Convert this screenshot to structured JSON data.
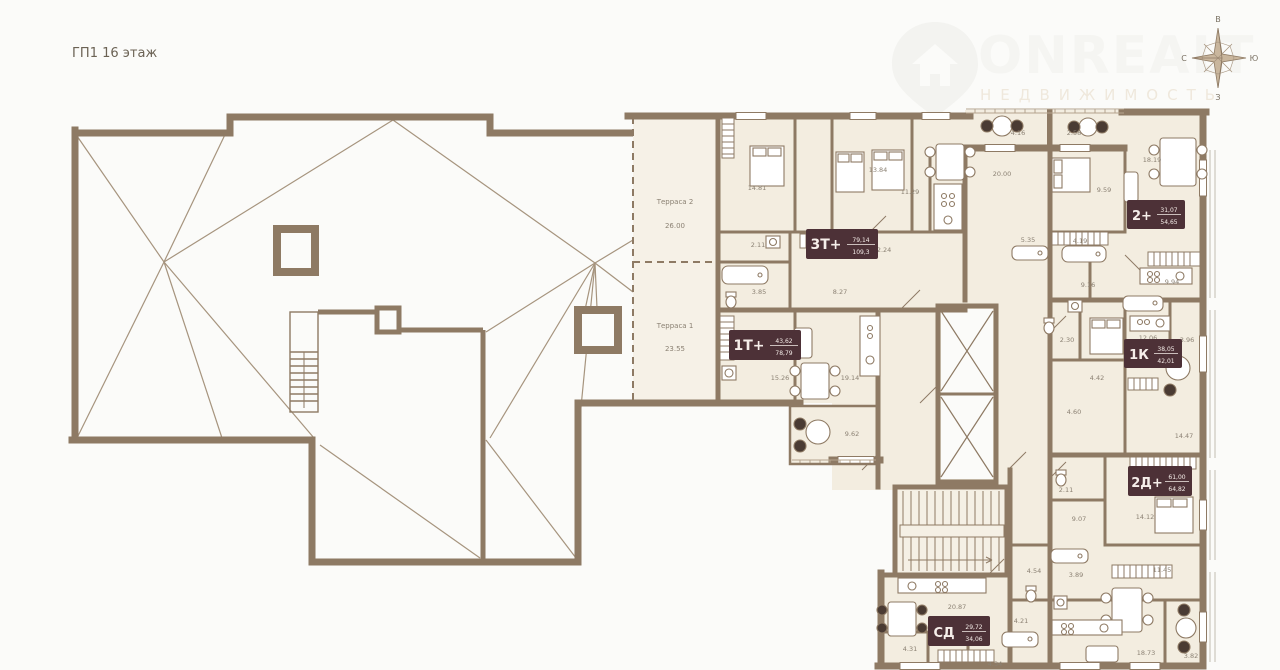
{
  "page": {
    "title": "ГП1 16 этаж"
  },
  "watermark": {
    "brand": "ONREALT",
    "subtitle": "НЕДВИЖИМОСТЬ"
  },
  "compass": {
    "top": "В",
    "right": "Ю",
    "bottom": "З",
    "left": "С"
  },
  "colors": {
    "wall": "#8e7a64",
    "room_fill": "#f3ede0",
    "badge_bg": "#4d3137",
    "label": "#8b8173"
  },
  "apartments": [
    {
      "code": "3Т+",
      "living_area": "79,14",
      "total_area": "109,3"
    },
    {
      "code": "1Т+",
      "living_area": "43,62",
      "total_area": "78,79"
    },
    {
      "code": "2+",
      "living_area": "31,07",
      "total_area": "54,65"
    },
    {
      "code": "1К",
      "living_area": "38,05",
      "total_area": "42,01"
    },
    {
      "code": "2Д+",
      "living_area": "61,00",
      "total_area": "64,82"
    },
    {
      "code": "СД",
      "living_area": "29,72",
      "total_area": "34,06"
    }
  ],
  "terraces": [
    {
      "name": "Терраса 2",
      "area": "26.00"
    },
    {
      "name": "Терраса 1",
      "area": "23.55"
    }
  ],
  "rooms": [
    {
      "area": "14.81"
    },
    {
      "area": "13.84"
    },
    {
      "area": "11.29"
    },
    {
      "area": "20.00"
    },
    {
      "area": "4.16"
    },
    {
      "area": "2.58"
    },
    {
      "area": "18.19"
    },
    {
      "area": "9.59"
    },
    {
      "area": "2.11"
    },
    {
      "area": "12.24"
    },
    {
      "area": "3.85"
    },
    {
      "area": "8.27"
    },
    {
      "area": "5.35"
    },
    {
      "area": "4.19"
    },
    {
      "area": "9.16"
    },
    {
      "area": "9.94"
    },
    {
      "area": "15.26"
    },
    {
      "area": "19.14"
    },
    {
      "area": "9.62"
    },
    {
      "area": "2.30"
    },
    {
      "area": "12.06"
    },
    {
      "area": "3.96"
    },
    {
      "area": "4.42"
    },
    {
      "area": "4.60"
    },
    {
      "area": "14.47"
    },
    {
      "area": "2.11"
    },
    {
      "area": "9.07"
    },
    {
      "area": "14.12"
    },
    {
      "area": "11.45"
    },
    {
      "area": "3.89"
    },
    {
      "area": "18.73"
    },
    {
      "area": "3.82"
    },
    {
      "area": "4.54"
    },
    {
      "area": "4.21"
    },
    {
      "area": "20.87"
    },
    {
      "area": "4.31"
    },
    {
      "area": "4.34"
    }
  ]
}
